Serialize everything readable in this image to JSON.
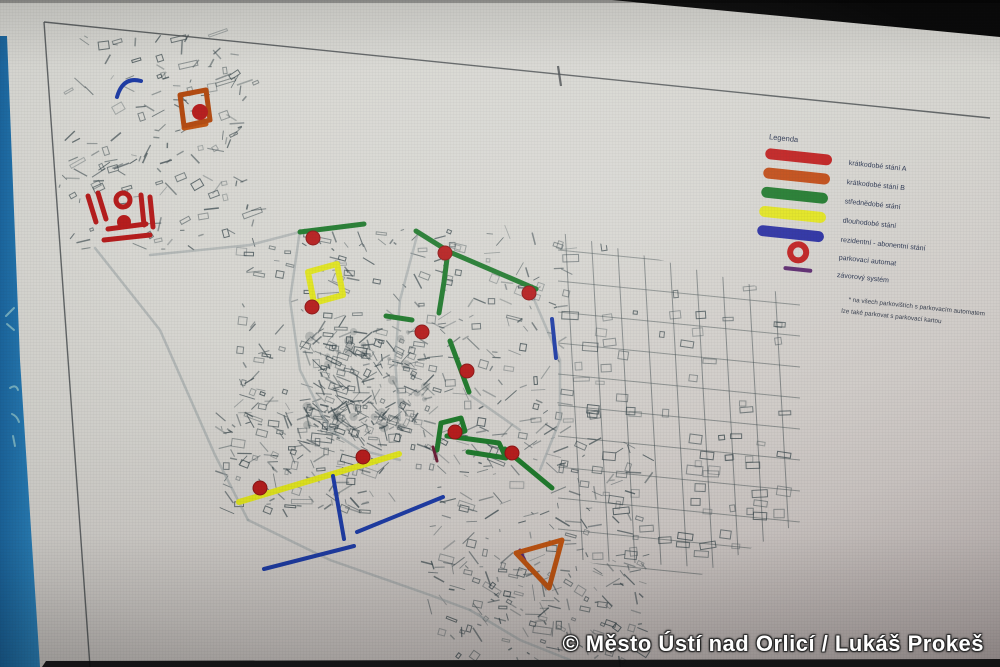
{
  "screen": {
    "watermark": "© Město Ústí nad Orlicí / Lukáš Prokeš"
  },
  "legend": {
    "title": "Legenda",
    "items": [
      {
        "label": "krátkodobé stání A",
        "swatch": "bar",
        "color": "#c01f1f"
      },
      {
        "label": "krátkodobé stání B",
        "swatch": "bar",
        "color": "#c14b15"
      },
      {
        "label": "střednědobé stání",
        "swatch": "bar",
        "color": "#207a2d"
      },
      {
        "label": "dlouhodobé stání",
        "swatch": "bar",
        "color": "#e2e41f"
      },
      {
        "label": "rezidentní - abonentní stání",
        "swatch": "bar",
        "color": "#2a2fa2"
      },
      {
        "label": "parkovací automat",
        "swatch": "ring",
        "color": "#c01f1f"
      },
      {
        "label": "závorový systém",
        "swatch": "thin-bar",
        "color": "#5c2a6f"
      }
    ],
    "note_lines": [
      "* na všech parkovištích s parkovacím automatem",
      "lze také parkovat s parkovací kartou"
    ]
  },
  "map": {
    "palette": {
      "red": "#b61d1d",
      "orange": "#c05512",
      "orange_dark": "#b34a10",
      "green": "#207a2d",
      "yellow": "#e0e41f",
      "blue": "#1f3da6",
      "purple": "#5c2a6f",
      "maroon": "#6b1f38"
    },
    "routes": [
      {
        "color": "green",
        "width": 5,
        "points": [
          [
            300,
            232
          ],
          [
            364,
            224
          ]
        ]
      },
      {
        "color": "green",
        "width": 5,
        "points": [
          [
            416,
            231
          ],
          [
            448,
            251
          ]
        ]
      },
      {
        "color": "green",
        "width": 5,
        "points": [
          [
            448,
            251
          ],
          [
            444,
            282
          ],
          [
            439,
            313
          ]
        ]
      },
      {
        "color": "green",
        "width": 5,
        "points": [
          [
            452,
            253
          ],
          [
            536,
            289
          ]
        ]
      },
      {
        "color": "green",
        "width": 5,
        "points": [
          [
            386,
            316
          ],
          [
            412,
            320
          ]
        ]
      },
      {
        "color": "green",
        "width": 5,
        "points": [
          [
            450,
            341
          ],
          [
            469,
            392
          ]
        ]
      },
      {
        "color": "green",
        "width": 5,
        "points": [
          [
            437,
            450
          ],
          [
            441,
            423
          ],
          [
            461,
            418
          ],
          [
            465,
            431
          ],
          [
            447,
            436
          ]
        ]
      },
      {
        "color": "green",
        "width": 5,
        "points": [
          [
            447,
            436
          ],
          [
            499,
            443
          ],
          [
            506,
            458
          ],
          [
            468,
            452
          ]
        ]
      },
      {
        "color": "green",
        "width": 5,
        "points": [
          [
            505,
            449
          ],
          [
            552,
            488
          ]
        ]
      },
      {
        "color": "yellow",
        "width": 6,
        "points": [
          [
            239,
            502
          ],
          [
            399,
            454
          ]
        ]
      },
      {
        "color": "blue",
        "width": 4,
        "points": [
          [
            552,
            319
          ],
          [
            556,
            358
          ]
        ]
      },
      {
        "color": "blue",
        "width": 4,
        "points": [
          [
            333,
            476
          ],
          [
            344,
            539
          ]
        ]
      },
      {
        "color": "blue",
        "width": 4,
        "points": [
          [
            357,
            532
          ],
          [
            443,
            497
          ]
        ]
      },
      {
        "color": "blue",
        "width": 4,
        "points": [
          [
            264,
            569
          ],
          [
            354,
            546
          ]
        ]
      },
      {
        "color": "orange",
        "width": 5,
        "points": [
          [
            184,
            128
          ],
          [
            206,
            124
          ]
        ]
      },
      {
        "color": "red",
        "width": 5,
        "points": [
          [
            88,
            196
          ],
          [
            96,
            222
          ]
        ]
      },
      {
        "color": "red",
        "width": 5,
        "points": [
          [
            98,
            193
          ],
          [
            106,
            219
          ]
        ]
      },
      {
        "color": "red",
        "width": 5,
        "points": [
          [
            141,
            195
          ],
          [
            144,
            225
          ]
        ]
      },
      {
        "color": "red",
        "width": 5,
        "points": [
          [
            150,
            197
          ],
          [
            153,
            227
          ]
        ]
      },
      {
        "color": "red",
        "width": 5,
        "points": [
          [
            108,
            229
          ],
          [
            146,
            224
          ]
        ]
      },
      {
        "color": "red",
        "width": 5,
        "points": [
          [
            104,
            240
          ],
          [
            150,
            235
          ]
        ]
      },
      {
        "color": "maroon",
        "width": 3,
        "points": [
          [
            433,
            447
          ],
          [
            437,
            461
          ]
        ]
      },
      {
        "color": "purple",
        "width": 3,
        "points": [
          [
            520,
            550
          ],
          [
            529,
            569
          ]
        ]
      }
    ],
    "shapes": [
      {
        "color": "yellow",
        "width": 6,
        "d": "M308,272 L337,264 L343,295 L314,303 Z"
      },
      {
        "color": "orange_dark",
        "width": 5,
        "d": "M180,95 L206,90 L210,120 L184,126 Z"
      },
      {
        "color": "orange",
        "width": 5,
        "d": "M516,553 L562,540 L549,588 Z"
      },
      {
        "color": "blue",
        "width": 4,
        "d": "M117,97 Q123,76 141,81"
      }
    ],
    "markers": [
      [
        313,
        238
      ],
      [
        445,
        253
      ],
      [
        529,
        293
      ],
      [
        312,
        307
      ],
      [
        422,
        332
      ],
      [
        467,
        371
      ],
      [
        260,
        488
      ],
      [
        363,
        457
      ],
      [
        455,
        432
      ],
      [
        512,
        453
      ]
    ],
    "blobs": [
      {
        "x": 200,
        "y": 112,
        "r": 8
      },
      {
        "x": 124,
        "y": 222,
        "r": 7
      }
    ],
    "rings": [
      {
        "x": 123,
        "y": 200,
        "r": 7
      }
    ]
  }
}
